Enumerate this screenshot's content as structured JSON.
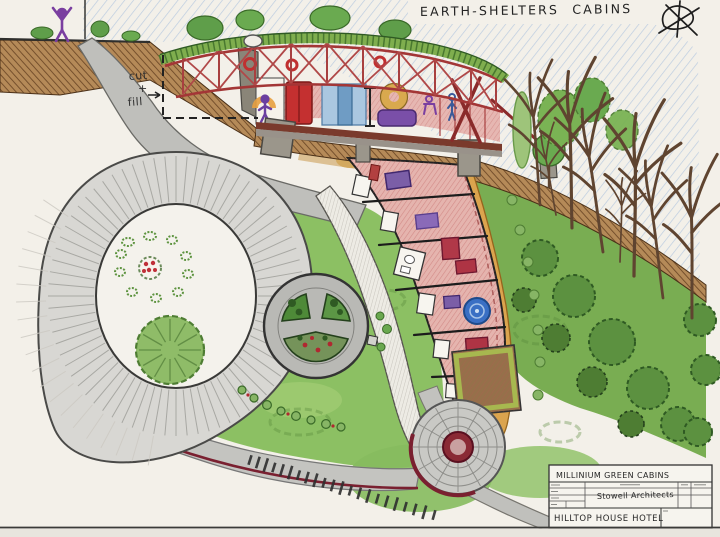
{
  "title": "EARTH-SHELTERS CABINS",
  "annotations": {
    "cut": "cut",
    "plus": "+",
    "fill": "fill"
  },
  "title_block": {
    "project": "MILLINIUM GREEN CABINS",
    "firm": "Stowell Architects",
    "client": "HILLTOP HOUSE HOTEL"
  },
  "palette": {
    "paper": "#f3f0e9",
    "sky_blue": "#a9c0dd",
    "grass_green": "#8cc063",
    "canopy_green": "#4e7d33",
    "earth_brown": "#6f4a28",
    "structure_red": "#a33636",
    "figure_purple": "#7a3fa0",
    "road_gray": "#c9c9c5",
    "walkway_orange": "#dba44e",
    "plaza_red": "#7a2030",
    "cabin_pink": "#e5b4ae",
    "bed_purple": "#7b5ea7",
    "rug_blue": "#3a6fc4"
  }
}
